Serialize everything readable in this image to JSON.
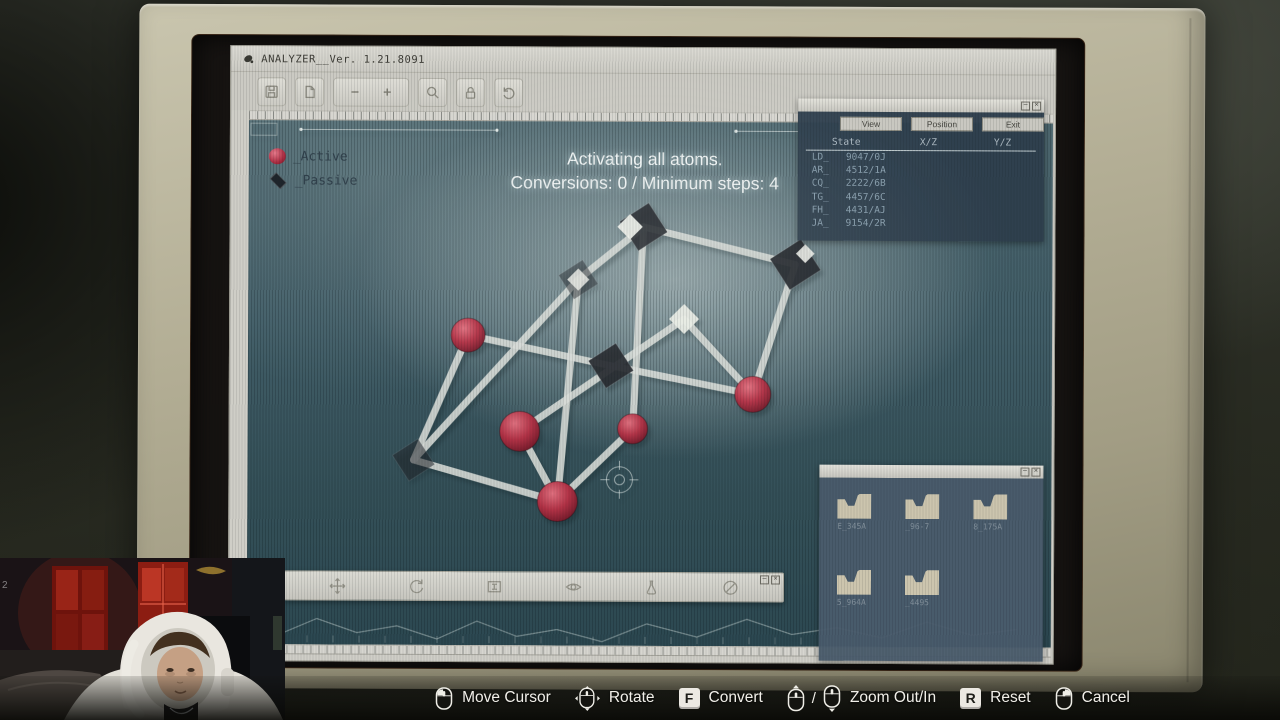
{
  "window": {
    "title": "ANALYZER__Ver. 1.21.8091",
    "minimize": "–",
    "close": "×"
  },
  "app_toolbar": {
    "buttons": [
      {
        "icon": "save"
      },
      {
        "icon": "page"
      },
      {
        "icon": "zoom-buttons",
        "minus": "−",
        "plus": "+"
      },
      {
        "icon": "search"
      },
      {
        "icon": "lock"
      },
      {
        "icon": "reset-view"
      }
    ]
  },
  "legend": {
    "active": "_Active",
    "passive": "_Passive"
  },
  "status": {
    "line1": "Activating all atoms.",
    "line2": "Conversions: 0 / Minimum steps: 4"
  },
  "state_panel": {
    "tabs": [
      "View",
      "Position",
      "Exit"
    ],
    "columns": [
      "State",
      "X/Z",
      "Y/Z"
    ],
    "rows": [
      {
        "id": "LD_",
        "value": "9047/0J"
      },
      {
        "id": "AR_",
        "value": "4512/1A"
      },
      {
        "id": "CQ_",
        "value": "2222/6B"
      },
      {
        "id": "TG_",
        "value": "4457/6C"
      },
      {
        "id": "FH_",
        "value": "4431/AJ"
      },
      {
        "id": "JA_",
        "value": "9154/2R"
      }
    ]
  },
  "folder_panel": {
    "folders": [
      "E_345A",
      "_96-7",
      "8_175A",
      "5_964A",
      "_4495"
    ]
  },
  "viewer_toolbar": {
    "icons": [
      "move",
      "rotate",
      "frame",
      "eye",
      "sample",
      "disable"
    ]
  },
  "molecule": {
    "nodes": [
      {
        "id": "A",
        "type": "sphere",
        "x": 220,
        "y": 214,
        "r": 17
      },
      {
        "id": "B",
        "type": "sphere",
        "x": 272,
        "y": 310,
        "r": 20
      },
      {
        "id": "C",
        "type": "sphere",
        "x": 310,
        "y": 380,
        "r": 20
      },
      {
        "id": "D",
        "type": "sphere",
        "x": 385,
        "y": 307,
        "r": 15
      },
      {
        "id": "E",
        "type": "sphere",
        "x": 505,
        "y": 272,
        "r": 18
      },
      {
        "id": "F",
        "type": "cube",
        "x": 166,
        "y": 339,
        "s": 30,
        "opacity": 0.55
      },
      {
        "id": "G",
        "type": "cube",
        "x": 363,
        "y": 244,
        "s": 32,
        "opacity": 0.95
      },
      {
        "id": "H",
        "type": "cube",
        "x": 395,
        "y": 105,
        "s": 34,
        "opacity": 0.92,
        "lit": "left"
      },
      {
        "id": "I",
        "type": "cube",
        "x": 547,
        "y": 142,
        "s": 36,
        "opacity": 0.95,
        "lit": "top"
      },
      {
        "id": "J",
        "type": "cube",
        "x": 330,
        "y": 158,
        "s": 28,
        "opacity": 0.5,
        "lit": "full"
      },
      {
        "id": "K",
        "type": "diamond",
        "x": 436,
        "y": 197,
        "s": 15
      }
    ],
    "edges": [
      [
        "A",
        "F"
      ],
      [
        "F",
        "C"
      ],
      [
        "C",
        "B"
      ],
      [
        "A",
        "G"
      ],
      [
        "C",
        "J"
      ],
      [
        "B",
        "K"
      ],
      [
        "D",
        "C"
      ],
      [
        "D",
        "H"
      ],
      [
        "H",
        "I"
      ],
      [
        "E",
        "I"
      ],
      [
        "E",
        "K"
      ],
      [
        "G",
        "E"
      ],
      [
        "J",
        "F"
      ],
      [
        "H",
        "J"
      ]
    ]
  },
  "hints": [
    {
      "icon": "mouse-left",
      "label": "Move Cursor"
    },
    {
      "icon": "mouse-move",
      "label": "Rotate"
    },
    {
      "key": "F",
      "label": "Convert"
    },
    {
      "icon": "mouse-wheel-up",
      "sep": "/",
      "icon2": "mouse-wheel-down",
      "label": "Zoom Out/In"
    },
    {
      "key": "R",
      "label": "Reset"
    },
    {
      "icon": "mouse-right",
      "label": "Cancel"
    }
  ],
  "webcam": {
    "corner_text": "2"
  },
  "colors": {
    "viewport_teal": "#3e5a64",
    "active_red": "#a92b40",
    "chrome": "#cfcec7",
    "bezel": "#aaa68d",
    "panel_slate": "#2e3f4d"
  }
}
